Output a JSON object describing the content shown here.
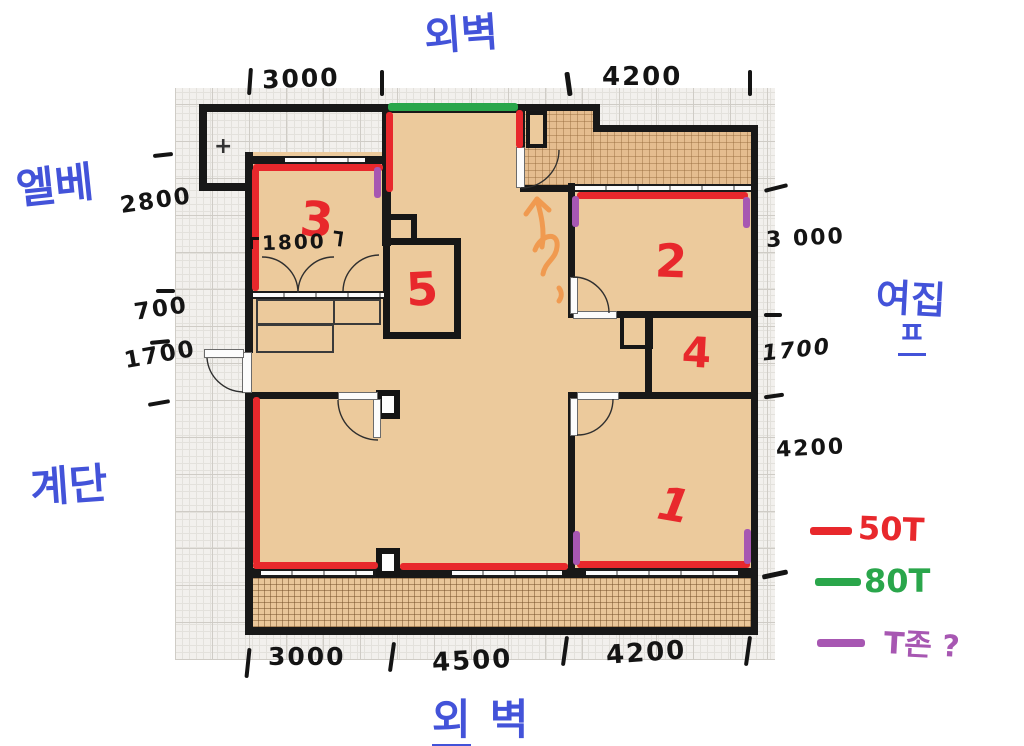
{
  "labels": {
    "top_exterior_wall": "외벽",
    "bottom_exterior_wall_part1": "외",
    "bottom_exterior_wall_part2": "벽",
    "elevator": "엘베",
    "stairs": "계단",
    "neighbor_line1": "여집",
    "neighbor_line2": "ㅍ",
    "plus_mark": "+",
    "question_mark": "?"
  },
  "room_numbers": [
    "1",
    "2",
    "3",
    "4",
    "5"
  ],
  "dimensions": {
    "top": [
      "3000",
      "4200"
    ],
    "left": [
      "2800",
      "700",
      "1700"
    ],
    "right": [
      "3 000",
      "1700",
      "4200"
    ],
    "bottom": [
      "3000",
      "4500",
      "4200"
    ],
    "room3_interior_width": "1800"
  },
  "legend": {
    "items": [
      {
        "label": "50T",
        "color": "#e8282c"
      },
      {
        "label": "80T",
        "color": "#2aa64b"
      },
      {
        "label": "T존 ?",
        "color": "#a757b2"
      }
    ]
  },
  "colors": {
    "red_50t": "#e8282c",
    "green_80t": "#2aa64b",
    "purple_tzone": "#a757b2",
    "blue_notes": "#4353d9",
    "orange_arrow": "#f09a50",
    "wall_black": "#181818",
    "floor_tan": "#ecca9c"
  }
}
